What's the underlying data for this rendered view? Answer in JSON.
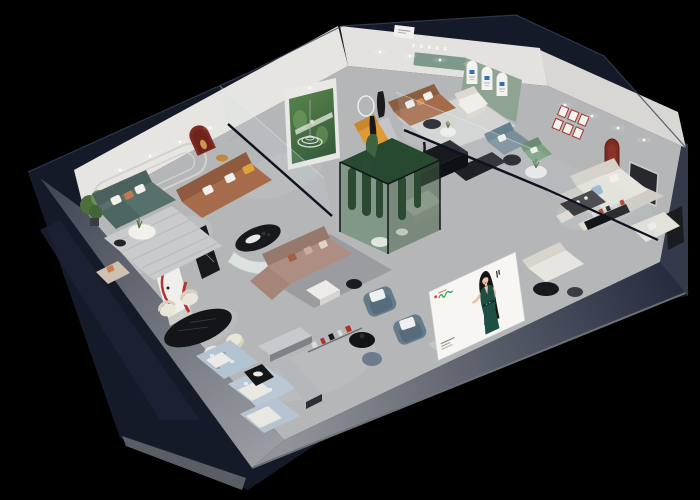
{
  "scene": {
    "description": "isometric-3d-cutaway-render-of-furniture-showroom",
    "background": "#000000"
  },
  "colors": {
    "wall_dark": "#151a28",
    "wall_white": "#e6e5e1",
    "floor_light": "#b4b6b8",
    "sofa_teal": "#57706b",
    "sofa_brown": "#a66b4b",
    "sofa_mauve": "#ae8d82",
    "sofa_cream": "#e6e4dd",
    "sofa_bluegrey": "#687d8a",
    "accent_red": "#7e2a22",
    "accent_red_bright": "#b4342c",
    "accent_orange": "#e09a33",
    "sage_wall": "#8fa392",
    "mural_green": "#3e6b46",
    "terrarium_green": "#5f8265",
    "marble_black": "#17191c",
    "rug_blue": "#b3c3d2",
    "billboard_bg": "#f7f6f3",
    "billboard_logo_green": "#2fa85c",
    "billboard_logo_red": "#d0382c",
    "dress_green": "#1e4f44",
    "hair_black": "#161616",
    "skin": "#eec0a6"
  },
  "billboard": {
    "brand_mark": "green-script-logo",
    "accent_mark": "red-square-mark",
    "figure": "woman-in-green-halter-dress-illustration",
    "caption_marks": "small-grey-text-lines"
  },
  "signage": {
    "wall_tagline": "illegible-small-wall-text",
    "arch_posters": "blue-logo-arch-cards",
    "top_plaque": "small-white-plaque",
    "picture_grid": "red-framed-picture-grid"
  }
}
